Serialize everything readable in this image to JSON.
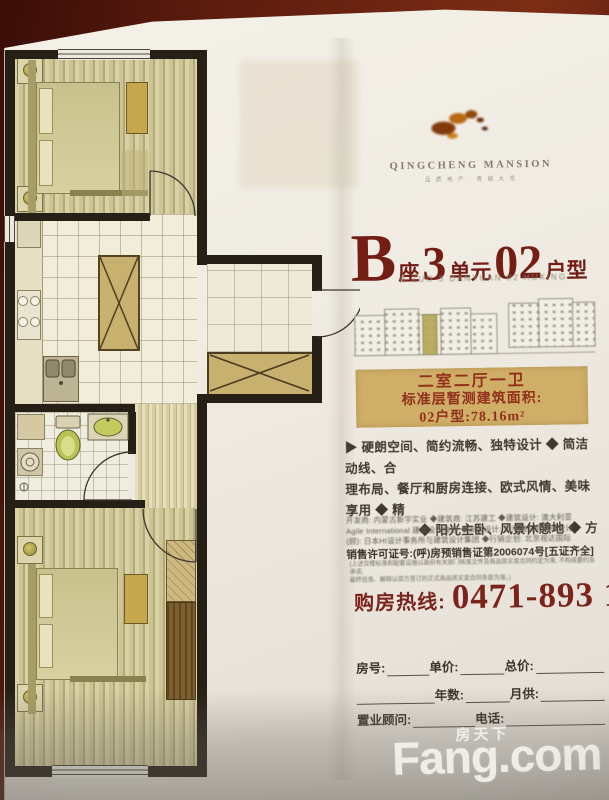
{
  "brand": {
    "logo_icon": "horse-logo",
    "name": "QINGCHENG MANSION",
    "tagline": "品 质 地 产 · 青 城 大 宅"
  },
  "unit_title": {
    "block": "B",
    "block_suffix": "座",
    "unit_no": "3",
    "unit_suffix": "单元",
    "model_no": "02",
    "model_suffix": "户型",
    "subtitle": "B ZUO 3 DANYUAN 02 HUXING"
  },
  "unit_info": {
    "layout": "二室二厅一卫",
    "area_label": "标准层暂测建筑面积:",
    "area_value": "02户型:78.16m²"
  },
  "features": {
    "line1": "▶ 硬朗空间、简约流畅、独特设计 ◆ 简洁动线、合",
    "line2": "理布局、餐厅和厨房连接、欧式风情、美味享用 ◆ 精",
    "line3": "◆ 阳光主卧、风景休憩地 ◆ 方"
  },
  "credits": {
    "line1": "开发商: 内蒙古新宇实业 ◆建筑商: 江苏建工 ◆建筑设计: 澳大利亚",
    "line2": "Agile International 建筑设计集团  ◆景观设计: 香港梅文鼎国际设计",
    "line3": "(顾): 日本HI设计事务所与建筑设计集团 ◆行销企划: 北京视达国际"
  },
  "license": {
    "text": "销售许可证号:(呼)房预销售证第2006074号[五证齐全]",
    "note1": "(上述交楼标准和配套设施以政府有关部门核准文件及商品房买卖合同约定为准, 不构成要约及承诺,",
    "note2": "最终信息、解释以双方签订的正式商品房买卖合同条款为准。)"
  },
  "hotline": {
    "label": "购房热线:",
    "number": "0471-893 1888"
  },
  "form": {
    "room_label": "房号:",
    "unit_price_label": "单价:",
    "total_price_label": "总价:",
    "years_label": "年数:",
    "monthly_label": "月供:",
    "consultant_label": "置业顾问:",
    "phone_label": "电话:"
  },
  "watermark": {
    "cn": "房天下",
    "en": "Fang.com"
  },
  "keyplan": {
    "icon": "building-elevation-sketch"
  }
}
